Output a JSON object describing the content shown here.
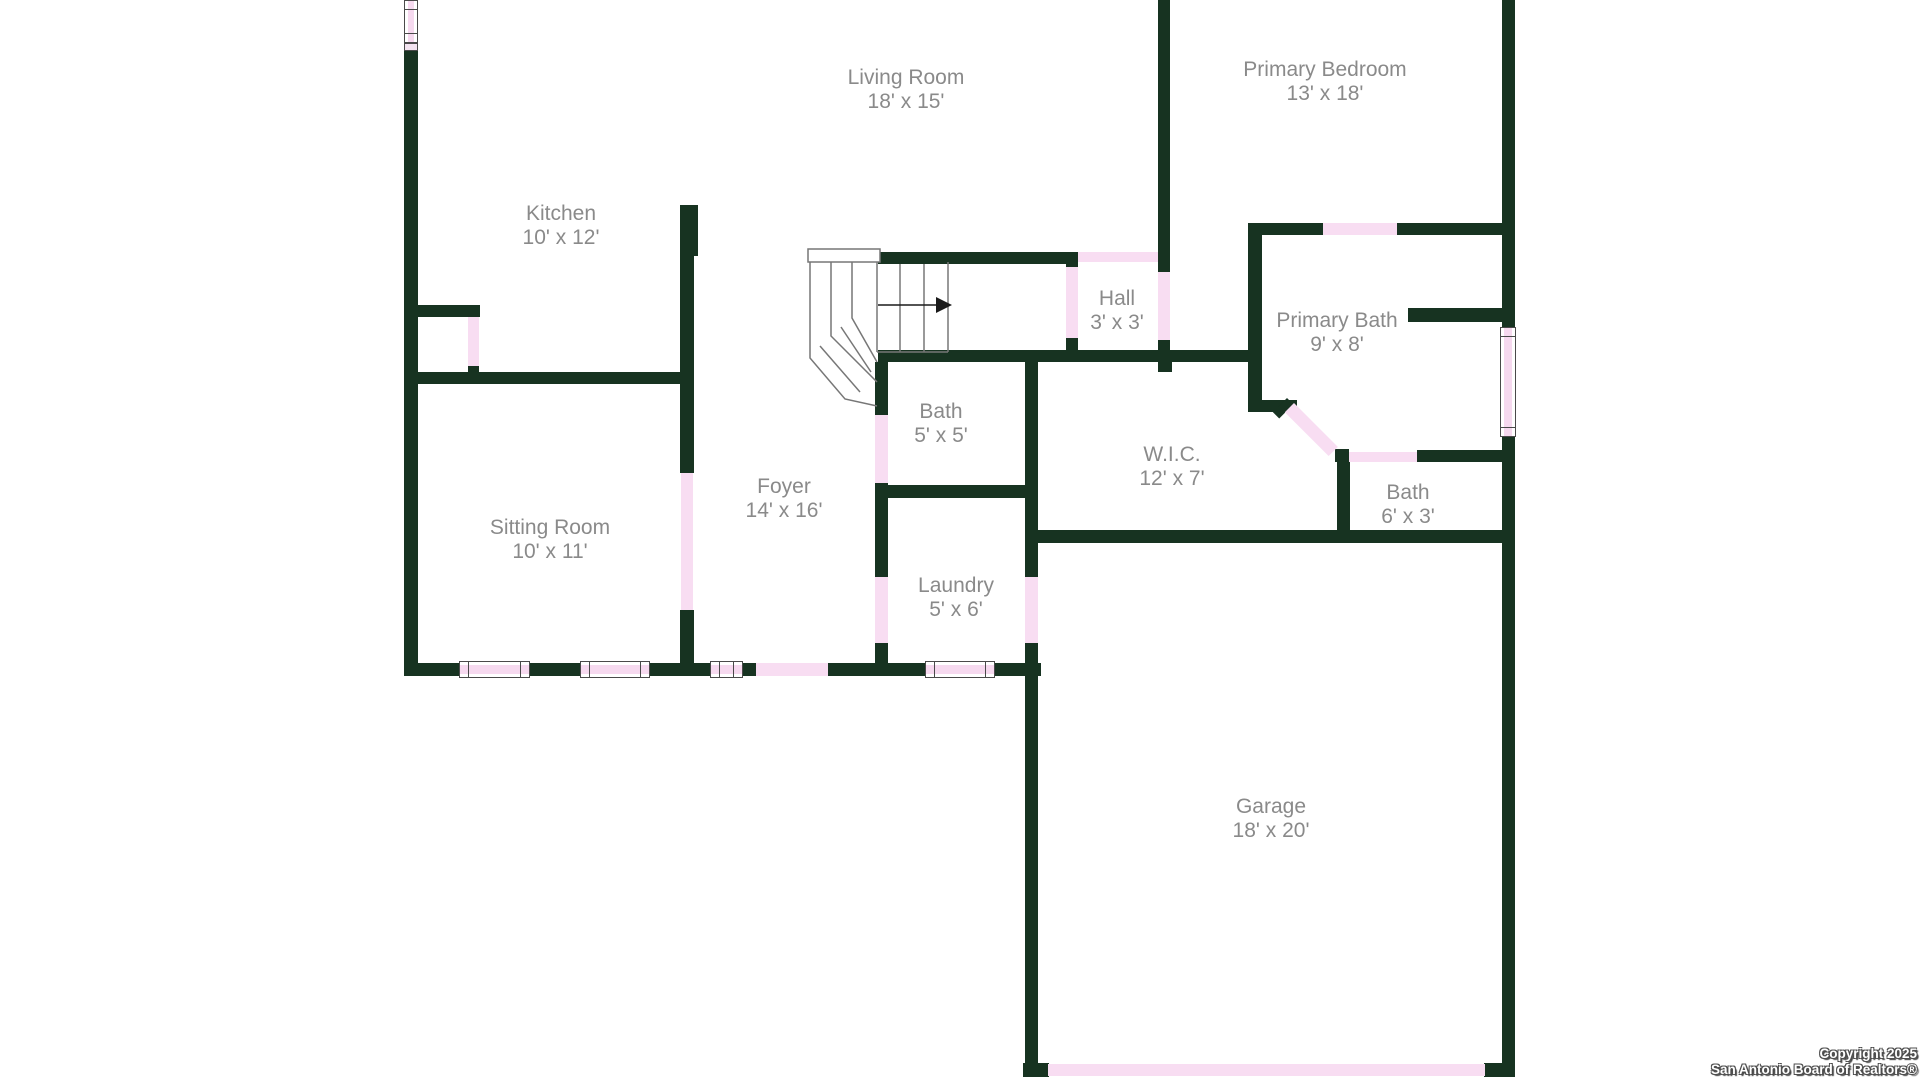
{
  "canvas": {
    "width": 1920,
    "height": 1080,
    "background": "#ffffff"
  },
  "colors": {
    "wall": "#173321",
    "door": "#f8ddf2",
    "window_fill": "#f6d9ef",
    "window_frame": "#4a4a4a",
    "stair_outline": "#777777",
    "arrow": "#1a1a1a",
    "label_text": "#8a8a8a",
    "copyright_text": "#ffffff"
  },
  "rooms": [
    {
      "id": "living-room",
      "name": "Living Room",
      "dims": "18' x 15'",
      "cx": 906,
      "top": 66
    },
    {
      "id": "primary-bedroom",
      "name": "Primary Bedroom",
      "dims": "13' x 18'",
      "cx": 1325,
      "top": 58
    },
    {
      "id": "kitchen",
      "name": "Kitchen",
      "dims": "10' x 12'",
      "cx": 561,
      "top": 202
    },
    {
      "id": "hall",
      "name": "Hall",
      "dims": "3' x 3'",
      "cx": 1117,
      "top": 287
    },
    {
      "id": "primary-bath",
      "name": "Primary Bath",
      "dims": "9' x 8'",
      "cx": 1337,
      "top": 309
    },
    {
      "id": "bath-small",
      "name": "Bath",
      "dims": "5' x 5'",
      "cx": 941,
      "top": 400
    },
    {
      "id": "wic",
      "name": "W.I.C.",
      "dims": "12' x 7'",
      "cx": 1172,
      "top": 443
    },
    {
      "id": "bath-guest",
      "name": "Bath",
      "dims": "6' x 3'",
      "cx": 1408,
      "top": 481
    },
    {
      "id": "foyer",
      "name": "Foyer",
      "dims": "14' x 16'",
      "cx": 784,
      "top": 475
    },
    {
      "id": "sitting-room",
      "name": "Sitting Room",
      "dims": "10' x 11'",
      "cx": 550,
      "top": 516
    },
    {
      "id": "laundry",
      "name": "Laundry",
      "dims": "5' x 6'",
      "cx": 956,
      "top": 574
    },
    {
      "id": "garage",
      "name": "Garage",
      "dims": "18' x 20'",
      "cx": 1271,
      "top": 795
    }
  ],
  "walls": [
    [
      404,
      50,
      14,
      626
    ],
    [
      404,
      663,
      56,
      13
    ],
    [
      530,
      663,
      51,
      13
    ],
    [
      649,
      663,
      62,
      13
    ],
    [
      743,
      663,
      14,
      13
    ],
    [
      828,
      663,
      98,
      13
    ],
    [
      994,
      663,
      47,
      13
    ],
    [
      1023,
      1063,
      26,
      14
    ],
    [
      1484,
      1063,
      31,
      14
    ],
    [
      1502,
      0,
      13,
      328
    ],
    [
      1502,
      436,
      13,
      641
    ],
    [
      1025,
      362,
      13,
      216
    ],
    [
      1025,
      643,
      13,
      434
    ],
    [
      1158,
      0,
      12,
      272
    ],
    [
      1158,
      340,
      12,
      22
    ],
    [
      878,
      252,
      188,
      12
    ],
    [
      1066,
      252,
      12,
      15
    ],
    [
      1066,
      338,
      12,
      14
    ],
    [
      878,
      350,
      374,
      12
    ],
    [
      1158,
      362,
      14,
      10
    ],
    [
      875,
      362,
      13,
      54
    ],
    [
      875,
      483,
      13,
      95
    ],
    [
      875,
      643,
      13,
      33
    ],
    [
      875,
      485,
      162,
      13
    ],
    [
      404,
      372,
      290,
      12
    ],
    [
      404,
      305,
      76,
      12
    ],
    [
      468,
      366,
      11,
      8
    ],
    [
      680,
      205,
      18,
      51
    ],
    [
      680,
      205,
      14,
      268
    ],
    [
      680,
      610,
      14,
      66
    ],
    [
      1248,
      223,
      14,
      189
    ],
    [
      1250,
      223,
      74,
      12
    ],
    [
      1397,
      223,
      105,
      12
    ],
    [
      1408,
      308,
      94,
      14
    ],
    [
      1252,
      400,
      45,
      12
    ],
    [
      1335,
      449,
      14,
      13
    ],
    [
      1417,
      450,
      85,
      12
    ],
    [
      1337,
      455,
      13,
      76
    ],
    [
      1025,
      530,
      490,
      13
    ]
  ],
  "doors": [
    {
      "name": "pantry-door",
      "rect": [
        468,
        317,
        11,
        49
      ]
    },
    {
      "name": "front-entry-door",
      "rect": [
        756,
        663,
        72,
        13
      ]
    },
    {
      "name": "garage-overhead-door",
      "rect": [
        1048,
        1064,
        437,
        12
      ]
    },
    {
      "name": "laundry-garage-door",
      "rect": [
        1025,
        577,
        13,
        66
      ]
    },
    {
      "name": "bath-door",
      "rect": [
        875,
        415,
        13,
        68
      ]
    },
    {
      "name": "laundry-foyer-door",
      "rect": [
        875,
        577,
        13,
        66
      ]
    },
    {
      "name": "sitting-room-door",
      "rect": [
        681,
        473,
        12,
        137
      ]
    },
    {
      "name": "hall-top-door",
      "rect": [
        1078,
        252,
        80,
        10
      ]
    },
    {
      "name": "hall-left-door",
      "rect": [
        1066,
        267,
        12,
        71
      ]
    },
    {
      "name": "hall-right-door",
      "rect": [
        1158,
        272,
        12,
        68
      ]
    },
    {
      "name": "primary-bedroom-door",
      "rect": [
        1323,
        223,
        74,
        12
      ]
    },
    {
      "name": "guest-bath-door",
      "rect": [
        1349,
        452,
        68,
        10
      ]
    }
  ],
  "diagonal_door": {
    "name": "primary-bath-diagonal-door",
    "x": 1294,
    "y": 403,
    "length": 62,
    "thickness": 13,
    "angle": 45,
    "cap": {
      "x": 1287,
      "y": 398,
      "length": 9,
      "thickness": 20,
      "angle": 45
    }
  },
  "windows": [
    {
      "name": "kitchen-window",
      "rect": [
        404,
        0,
        14,
        43
      ],
      "orient": "v"
    },
    {
      "name": "sitting-window-1",
      "rect": [
        459,
        661,
        71,
        17
      ],
      "orient": "h"
    },
    {
      "name": "sitting-window-2",
      "rect": [
        580,
        661,
        70,
        17
      ],
      "orient": "h"
    },
    {
      "name": "foyer-window",
      "rect": [
        710,
        661,
        33,
        17
      ],
      "orient": "h"
    },
    {
      "name": "laundry-window",
      "rect": [
        925,
        661,
        70,
        17
      ],
      "orient": "h"
    },
    {
      "name": "primary-bath-window",
      "rect": [
        1500,
        327,
        16,
        110
      ],
      "orient": "v"
    }
  ],
  "window_sill": [
    404,
    43,
    14,
    8
  ],
  "stairs": {
    "header_rect": [
      808,
      249,
      72,
      13
    ],
    "polylines": [
      [
        [
          810,
          262
        ],
        [
          810,
          358
        ],
        [
          845,
          399
        ],
        [
          877,
          406
        ]
      ],
      [
        [
          831,
          262
        ],
        [
          831,
          336
        ],
        [
          877,
          382
        ]
      ],
      [
        [
          852,
          262
        ],
        [
          852,
          318
        ],
        [
          877,
          362
        ]
      ],
      [
        [
          820,
          346
        ],
        [
          860,
          392
        ]
      ],
      [
        [
          841,
          327
        ],
        [
          871,
          372
        ]
      ],
      [
        [
          877,
          262
        ],
        [
          877,
          352
        ]
      ],
      [
        [
          900,
          264
        ],
        [
          900,
          352
        ]
      ],
      [
        [
          924,
          264
        ],
        [
          924,
          352
        ]
      ],
      [
        [
          948,
          262
        ],
        [
          948,
          352
        ]
      ],
      [
        [
          877,
          352
        ],
        [
          948,
          352
        ]
      ]
    ],
    "arrow": {
      "x1": 878,
      "y1": 305,
      "x2": 936,
      "y2": 305,
      "head": [
        [
          936,
          297
        ],
        [
          952,
          305
        ],
        [
          936,
          313
        ]
      ]
    }
  },
  "copyright": {
    "line1": "Copyright 2025",
    "line2": "San Antonio Board of Realtors®"
  }
}
